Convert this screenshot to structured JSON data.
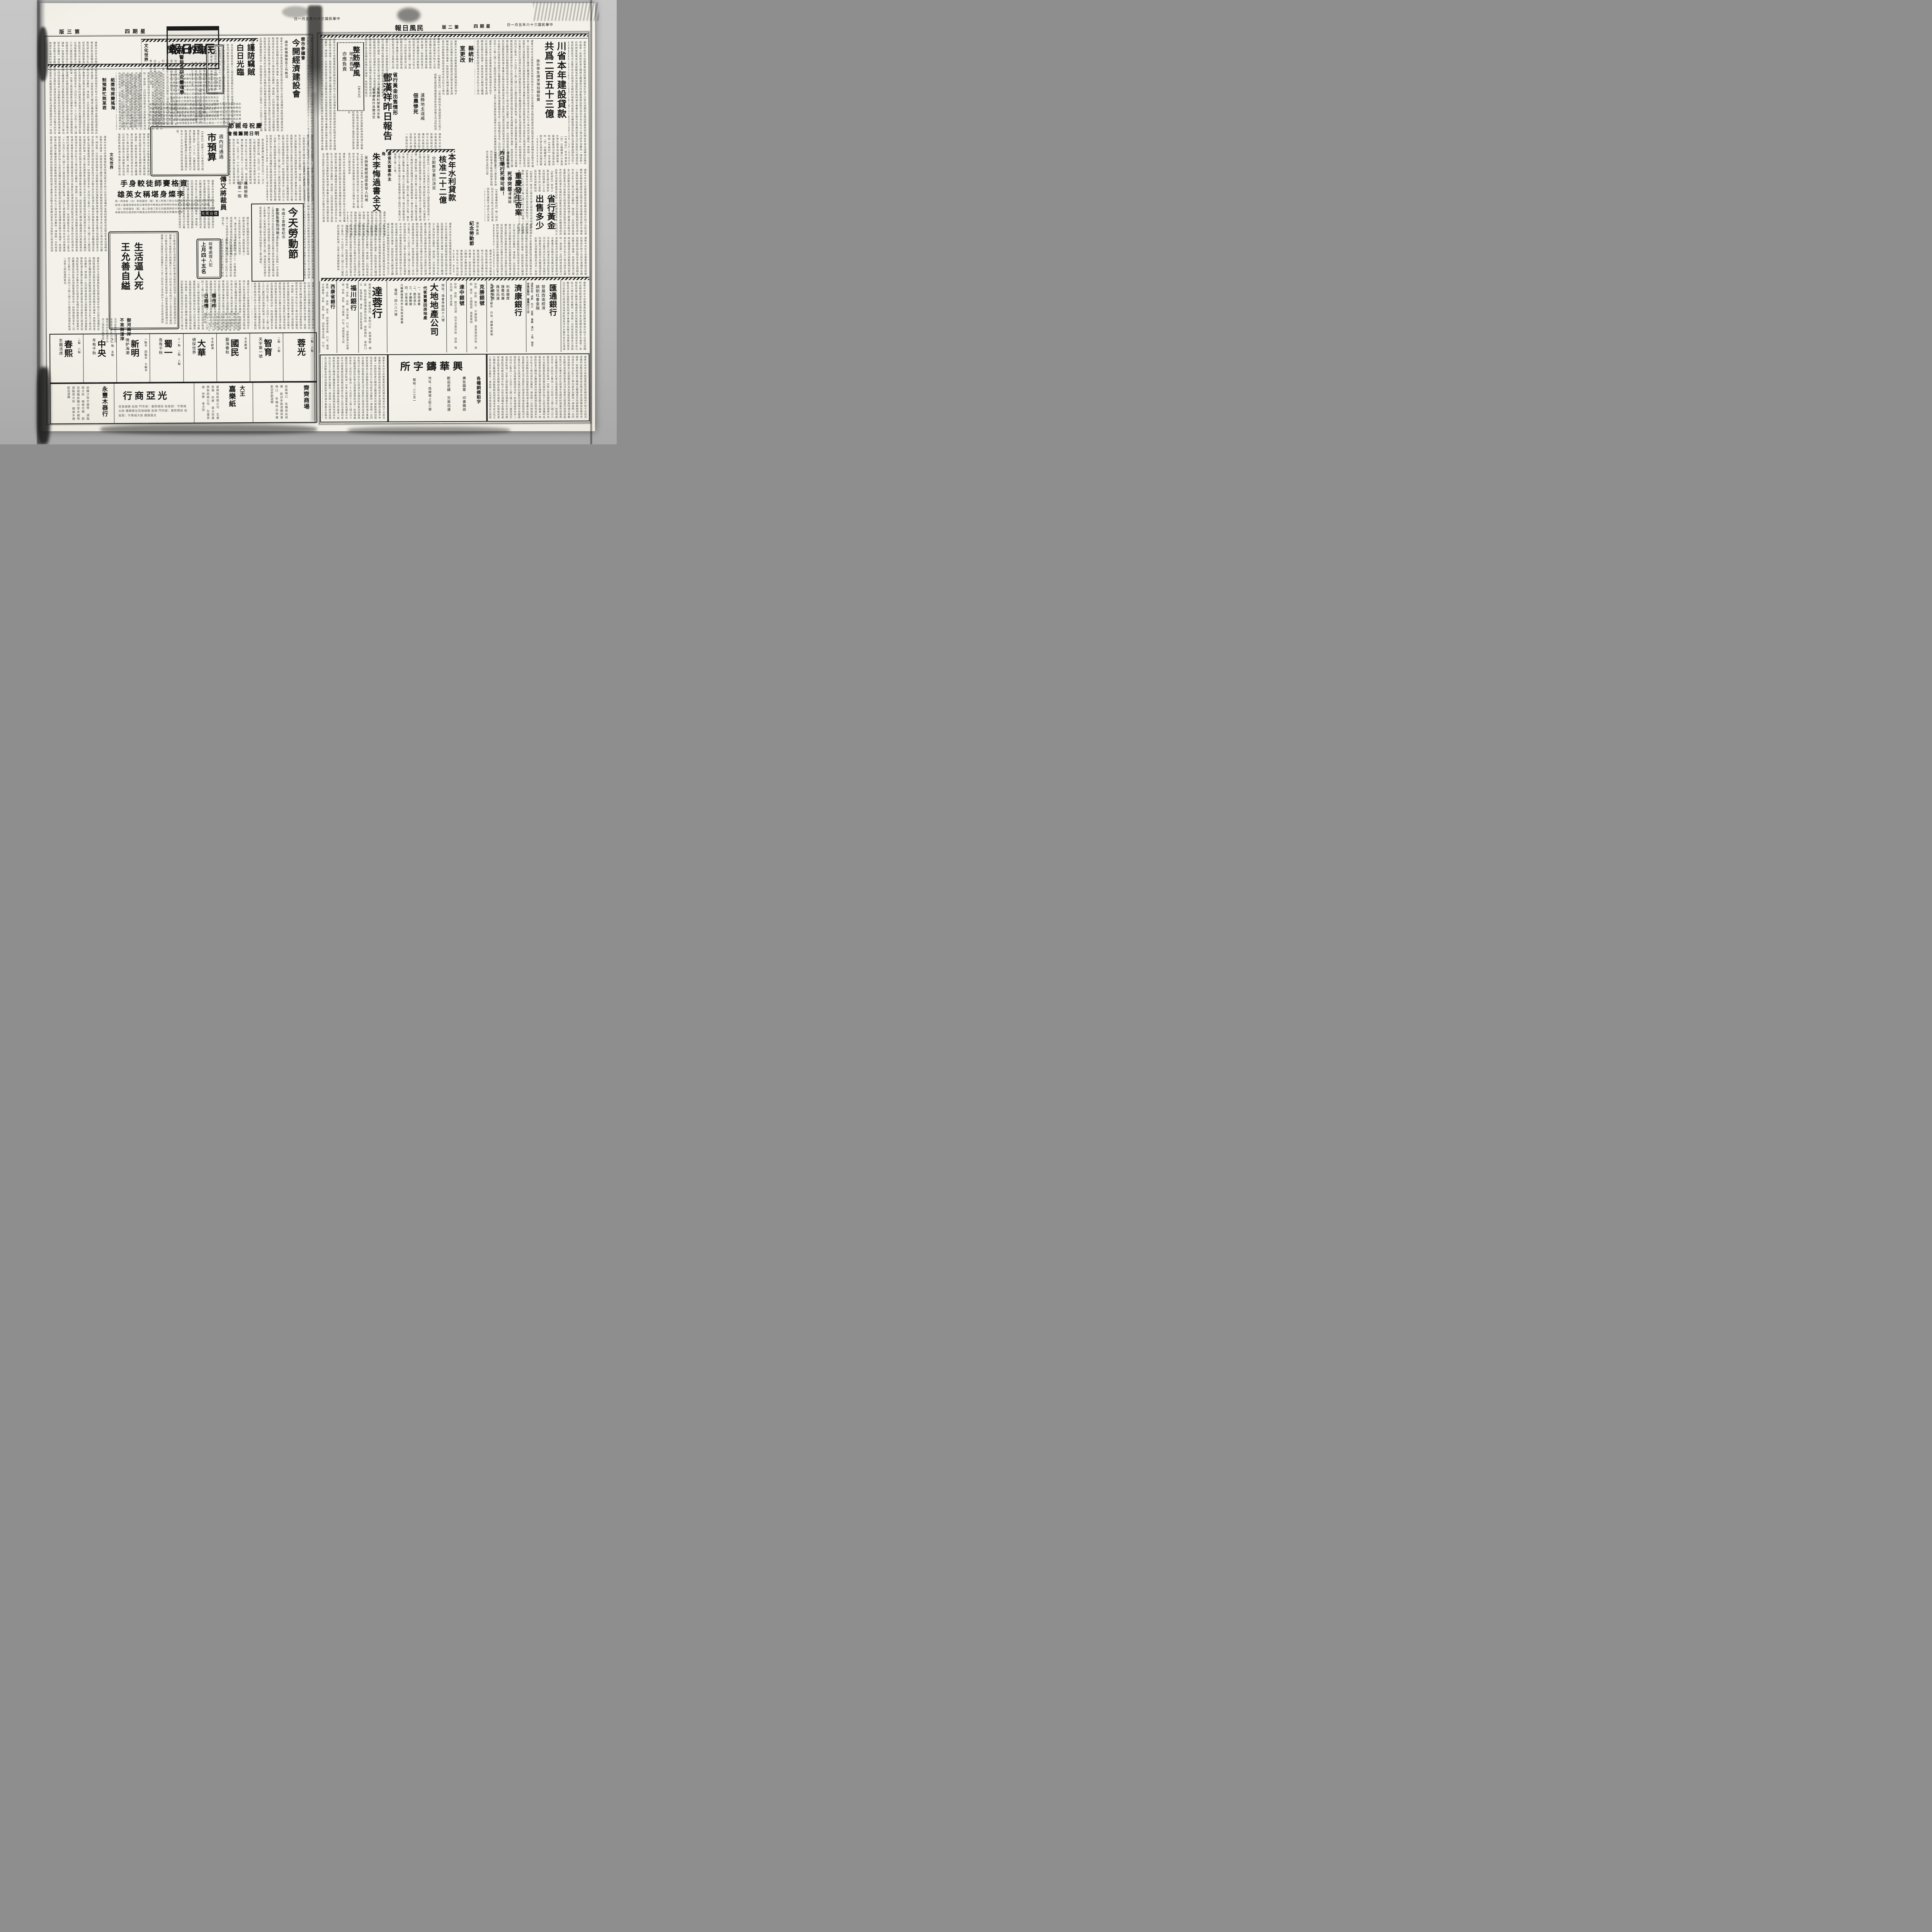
{
  "masthead": {
    "title_visual": "報日風民",
    "date_visual": "日一月五年六十三國民華中"
  },
  "left_page": {
    "edition_visual": "版三第",
    "weekday_visual": "四期星",
    "section_kicker": "文化世界",
    "articles": {
      "ghost": {
        "headline_visual": "聞新的鬼",
        "subhead": "警局決研究靈魂學",
        "body": "如何時鬼語神態經怪忽起各人士之注意昨晚（三十）記者探訪時動作未停止離奇之狀此種神祕警局決定將來帶局研究並多方設法研究因變態心理學及靈魂學之研究資料云（普）"
      },
      "burglar": {
        "kicker": "閣下府上留意",
        "headline_a": "謹防竊賊",
        "headline_b": "白日光臨",
        "agency": "【文建社訊】",
        "body": "本市青年路青年里十三號店民黃集於昨日午飯後鎖門外出午後三時返家見門鎖被扭失去財物頗多現該管當局對此案甚爲注意刻正派員查緝中。",
        "sidebox": "【本報訊】昨日（三十）本報所載本市東順城街必勝里五號附六號店民劉漢文之學徒朱立學弟婦楊秀"
      },
      "econ": {
        "kicker": "蓉市參議會",
        "headline": "今開經濟建設會",
        "subhead": "請市級機關報告工作概況"
      },
      "budget": {
        "headline": "市預算",
        "subhead": "週內可通過",
        "body": "【中新社】成都三十六年度地方總預算已於日前送呈省府業經省府總會審計處於（二十九）日審核完竣頃於會議進行順利本市預算週內可能通過總數審議處已如期竣事預計本月十五日內可能送省務會議通過。"
      },
      "mothers": {
        "headline_visual": "節親母祝慶",
        "headline2_visual": "會備籌開日明",
        "body": "更爲愼重擴大慶祝本年五月十一日之母親節定於明（五月二日）下午五至七時由教育社市長李鉄夫黨部大禮堂邀請成都實業處長黃仲翔廳長劉明揚本市各公私立小學均參加。"
      },
      "layoffs": {
        "kicker_a": "義務勞動",
        "kicker_b": "成果一般",
        "headline": "傳又將裁員",
        "body": "據可靠方面獲悉該府因市財政現狀無法維持現有人員擬將裁員二十名故該府各科室人員均惴惴不安。"
      },
      "boxing": {
        "badge_visual": "光風台擂",
        "headline_visual": "手身較徒師賽格資",
        "headline2_visual": "雄英女稱堪身燦李",
        "body": "第一對第乾（白）對張國培（藍）第二對第三對王四腿兩陣背中掌汝塘對技兩英陣人部時人藝陣再舉良對白章而對中騎黃此對明得所時佳賓各對獲具絕取"
      },
      "labor": {
        "headline": "今天勞動節",
        "subhead_a": "市總工會開會紀念",
        "subhead_b": "影院免費招待勞工",
        "body": "【國民社訊】今（一日）爲勞動節全市工友放假一日並由總工會商請本市各影院有關機關及各業代表參加會後各業代表舉行特定於午前九時假提督街三義廟內舉行慶祝大會通知各工會負責人及會員均將參加慶祝各工廠一律放假同時各廠方發放獎金以資鼓勵又蓉市府特撥款五十萬元補助。"
      },
      "suicide": {
        "headline_a": "生活逼人死",
        "headline_b": "王允善自縊",
        "body": "以小販爲生因生活逼迫於昨晨在寓自縊身死經保甲人員發覺報請處理御河中捕獲之大邑匪徒已由綏署於三十月二份在內之本市西分十三名五名部共處四"
      },
      "prisoners": {
        "kicker": "綏署處理人犯",
        "headline": "上月四十五名",
        "body": "【本報訊】（三十）日警備部前十時記者招待由司令部黃滿元參謀長代稱四月份處理人犯四十五名判刑移送本部於日前執行院前八名做役場二十五名華嚴巷血案兇犯㈠移送法院㈡劃役繼則考送㈢以說明世正處死比事案時隨處理情形覺得過重因社會處以人極事均主政府但此種整明處刑施"
      },
      "market": {
        "headline_a": "蓉市昨",
        "headline_b": "日商情",
        "body": "布疋均蓋陰頭煙市售場五丹旺仍售價狂漲球一各揚隨貨上市井百地零九興與續金河一七六五六作五六一五〇工與東大街"
      },
      "river": {
        "headline_a": "御河兩岸",
        "headline_b": "不准倒渣滓",
        "body": "沿河各居民已疏濬完竣填高起見免河中淤塞市府亦在疏濬中沿河上架設衣服被盜"
      },
      "pulp": {
        "headline_a": "紙漿地將變搖海",
        "headline_b": "制預算忙煞某君"
      }
    },
    "theaters": [
      {
        "name": "春熙",
        "film": "生龍活虎",
        "times": "二點 八點"
      },
      {
        "name": "中央",
        "film": "冬有千秋",
        "times": "十一點 五點"
      },
      {
        "name": "新明",
        "film": "情妒海潮",
        "times": "一點半 四點半 七點半"
      },
      {
        "name": "蜀一",
        "film": "各有千秋",
        "times": "十一點 二點 八點"
      },
      {
        "name": "大華",
        "film": "偵探世界",
        "times": "今天獻演"
      },
      {
        "name": "國民",
        "film": "藝海春秋",
        "times": "今天獻演"
      },
      {
        "name": "智育",
        "film": "天字第一號",
        "times": "二點 八點"
      },
      {
        "name": "蓉光",
        "film": "",
        "times": "一點 八點"
      }
    ],
    "shops": [
      {
        "name": "永豐木器行",
        "lines": "欲購沙發木器等 請臨南大街 精美木器 歡迎選購"
      },
      {
        "name_visual": "行商亞光",
        "lines": "百貨總匯 批發 門市部：春熙南段 批發部：守東城大街 僑匯匯兌"
      },
      {
        "name": "嘉樂紙",
        "tag": "大王",
        "lines": "嘉樂製紙廠公司 生產普遍 供應 東大街"
      },
      {
        "name": "齊齊商場",
        "lines": "商業場口 各種商品俱備 歡迎參觀選購"
      }
    ]
  },
  "right_page": {
    "edition_visual": "版二第",
    "weekday_visual": "四期星",
    "articles": {
      "loan": {
        "headline": "川省本年建設貸款",
        "headline2": "共爲二百五十三億",
        "subhead": "旅外學生請求增加補助費",
        "body": "【本報訊】省參議會昨（卅）日繼續舉行大會旅外學生請求增加補助費一案議會垂詢決議送請省府核辦"
      },
      "stat": {
        "headline_a": "縣統計",
        "headline_b": "室更改"
      },
      "discipline": {
        "agency": "【新元社】",
        "headline": "整飭學風",
        "subhead_a": "地方長官",
        "subhead_b": "亦應負責",
        "body": "省府爲加強整飭學風特通令專署及各縣市局長嚴加管束負責整飭如再發現學風不整當局亦應負責云"
      },
      "tax": {
        "body": "遵奉中央命令供應軍需起見除嚴加徵收外特于日前迅速囑咐各縣田賦處致函此間省參會並請轉函各縣市參議會一致贊助該會已轉請全體議員共同推動務期如限完成"
      },
      "deng": {
        "kicker": "省行黃金出售情形",
        "headline": "鄧漢祥昨日報告",
        "subhead_a": "有關材料搜集完全後",
        "subhead_b": "省參會再作具體決定",
        "body": "【華西社訊】省行黃金出售是否由省參會核定對各參議後再作具體處理有關材料搜集完竣後認爲此事必須愼重處理故決定一致辦理"
      },
      "lu": {
        "headline_a": "瀘縣地主逞威",
        "headline_b": "佃農慘死",
        "body": "【華夏社訊】川南分縣和地主鄉調戲其女欠租之錢醫治無錢受傷頗重遂致身死家屬正向法院起訴"
      },
      "water": {
        "headline": "本年水利貸款",
        "headline2": "核准二十二億",
        "subhead": "分配數字業已決定",
        "body": "【華夏社】三十六年度四川省水利工程緊急貸款原爲一十六億元新由中央核准增貸六億元即將分別貸與下列灌溉及水電工程緊急應用合堰六千萬彭明紅惟埝三千萬羅江畔湖堰一億寧四聯埝二億四千萬三台司亭堰八千萬洪雅花溪堰八千萬綿竹官宋橎堰五千萬綿陽龍西東一億五千萬成都自來水六千萬充青居街水電二億四千萬江津白沙水電一億五千萬江鹽嘴水電一億元三台柳林灘水電一億元巴縣槃溪河工程八千萬華陽沙堰五千萬灌縣導江堰工程四千萬東川大瑪堰三億一千萬。"
      },
      "zhu": {
        "kicker": "康省天窗事件主角",
        "headline": "朱李悔過書全文",
        "subhead": "呈訴叛變經過原委受人利用",
        "body": "【本報雅安卅日專電】康省前次天窗事件之朱世正李元亨等因受政界得原文如下該去會公雅世年多季突有身膺軍服之徐光生又稱有人來鄉接洽口頭名地遂自"
      },
      "chongqing": {
        "headline": "重慶發生奇案",
        "kicker_a": "丈夫身死",
        "kicker_b": "妻有嫌疑",
        "slogan_a": "死得突然！",
        "slogan_b": "死得可疑！",
        "body": "【本報重慶航訊】晚八時許四月廿五日熊文貞及同學張因皆其妻堅不承認乃夫保忠一併撥局偵訊報告乃向該管天花"
      },
      "gold": {
        "headline_a": "省行黃金",
        "headline_b": "出售多少",
        "body": "【新夏社】原存之黃金及盧比銀被前任總經理康心之出售事各方所注意概爲記者探得數點如下㈠黃金存量原爲一千六百八十兩八錢三分六厘㈡出售一千六百餘兩截至本年二月四日止售出一千六百四十三兩八錢三分六厘因成份過壞折耗達一百零七兩故實際售出"
      },
      "meeting": {
        "kicker": "康省致縣長",
        "headline": "昨日舉行",
        "body": "【康藏社】康定川康監李永振同日抵會道炎魁首屆縣長延期卅日舉試主席因公留"
      },
      "memorial": {
        "kicker": "渝市各界",
        "headline": "紀念勞動節"
      }
    },
    "ads": {
      "huitong": {
        "name": "匯通銀行",
        "slogan_a": "發展西南經濟",
        "slogan_b": "調劑社會金融",
        "branches": "通匯地點：成都 內江 宜賓 重慶 漢口 上海 雅安 康定 樂山 西昌",
        "branch_addr": "成都分行 走馬街五三號"
      },
      "jikang": {
        "name": "濟康銀行",
        "slogan_a": "利息優厚",
        "slogan_b": "匯費低廉",
        "slogan_c": "匯兌迅速",
        "slogan_d": "手續簡便",
        "addr": "通匯國內各大都市 行址：成都北新街"
      },
      "kesheng": {
        "name": "克勝銀號",
        "lines": "存款 放款 匯兌 手續簡便 基業鞏固"
      },
      "dazhong": {
        "name": "達中銀號",
        "lines": "存款 放款 匯兌迅速 信孚卓著"
      },
      "dadi": {
        "name": "大地地產公司",
        "addr": "地址：海會寺街四十八號",
        "line1": "代客買賣田房地產",
        "p1": "一、信用卓著",
        "p2": "二、歷史悠久",
        "p3": "三、手續簡捷",
        "p4": "四、交易迅速",
        "note": "凡賜顧諸君向本公司接洽營業",
        "tel": "電話：四八八六號"
      },
      "darong": {
        "name": "達蓉行",
        "lines": "美貨化裝品 密斯佛陀 香粉口紅 裝璜美觀 禮盒 歡迎參觀選購"
      },
      "fuchuan": {
        "name": "福川銀行",
        "lines": "業務：存款 放款 實力雄健 行址：成都西東大街"
      },
      "xikang": {
        "name": "西康省銀行",
        "lines": "業務：存款 放款 匯兌 調劑康省金融 行址：暑襪中街"
      },
      "xinghua": {
        "name_visual": "所字鑄華興",
        "l1": "各種銅模鉛字",
        "l2": "廣告圖章 印書雜誌",
        "l3": "歡迎定鑄 交貨迅速",
        "l4": "地址：西順城上街三號",
        "l5": "報話：二二五一"
      }
    }
  },
  "filler": "遵奉中央命令供應軍需起見除嚴加徵收外特于日前迅速囑咐各縣田賦處致函此間省參會並請轉函各縣市參議會一致贊助該會已轉請全體議員共同推動務期如限完成本市各公私立小學均將參加慶祝一律放假一日同時發放獎金以資鼓勵省府爲加強整飭學風特通令專署及各縣市局長嚴加管束沿河各居民已疏濬完竣填高起見免河中淤塞市府亦在疏濬中有關材料搜集完竣後再作具體處理認爲此事必須愼重處理故決定一致辦理截至本年二月四日止售出一千六百四十三兩八錢三分六厘因成份過壞折耗達一百零七兩故實際售出"
}
